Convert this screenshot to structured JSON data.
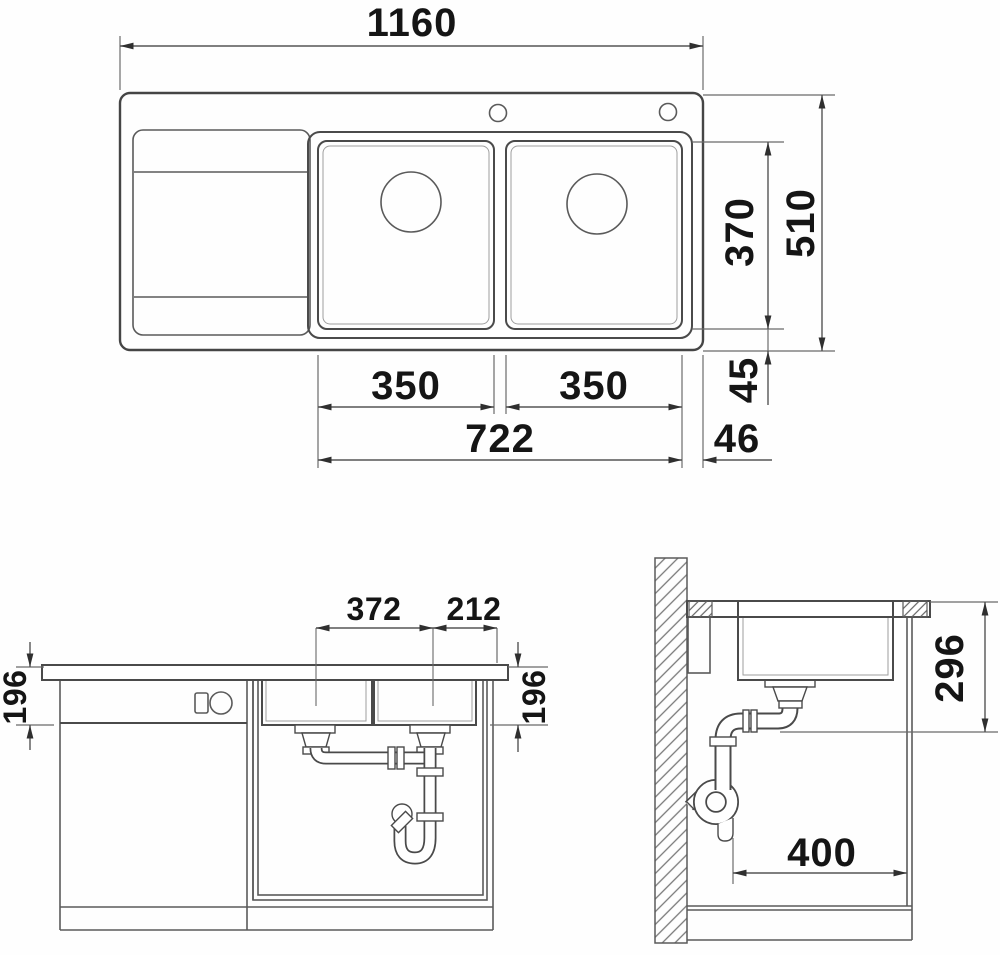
{
  "drawing": {
    "type": "sink-installation-dimension-drawing",
    "colors": {
      "line": "#4a4a4a",
      "dim_line": "#555555",
      "text": "#151515",
      "background": "#ffffff"
    }
  },
  "views": {
    "top_view": {
      "dims": {
        "overall_width": "1160",
        "overall_depth": "510",
        "bowl_field_depth": "370",
        "rear_rim": "45",
        "right_rim": "46",
        "bowl1_width": "350",
        "bowl2_width": "350",
        "bowls_overall": "722"
      }
    },
    "front_view": {
      "dims": {
        "drain_spacing": "372",
        "drain_to_edge": "212",
        "bowl_depth_left": "196",
        "bowl_depth_right": "196"
      }
    },
    "side_view": {
      "dims": {
        "underside_depth": "296",
        "wall_clearance": "400"
      }
    }
  }
}
